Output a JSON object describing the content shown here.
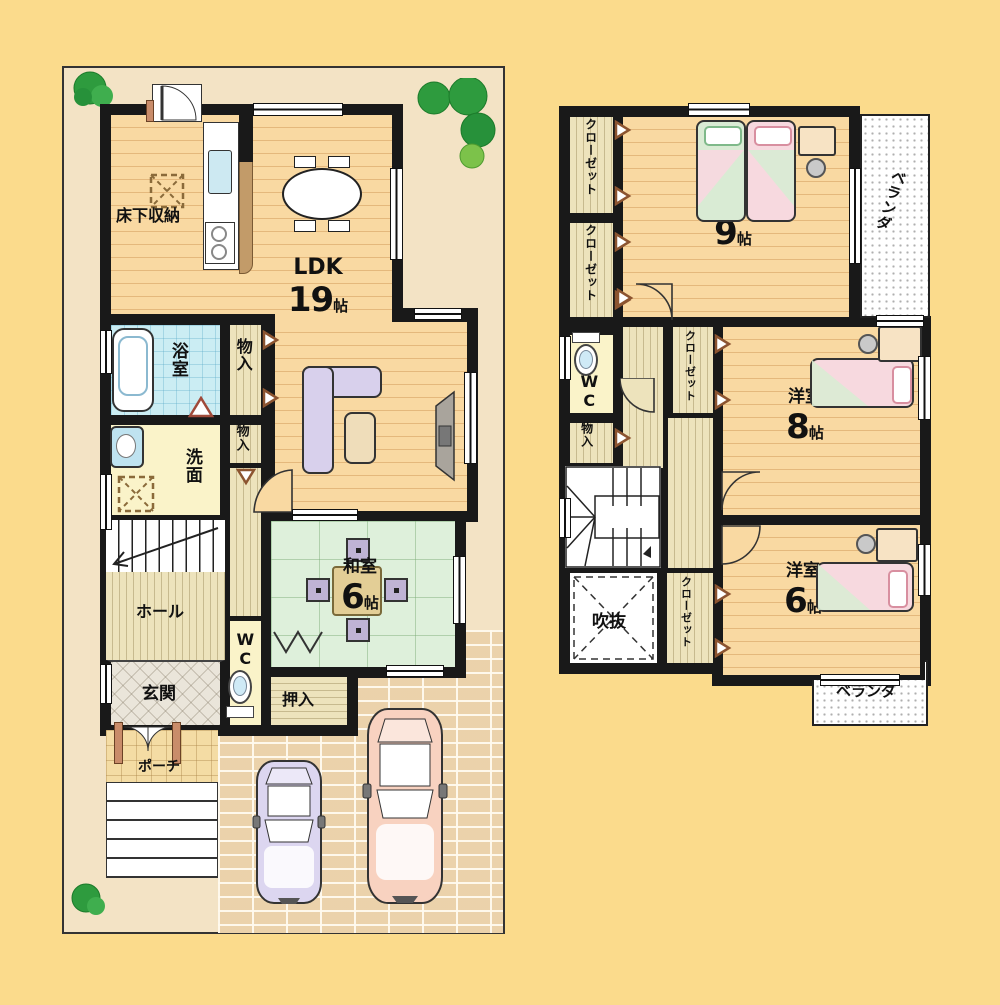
{
  "floor1": {
    "rooms": {
      "ldk": {
        "label": "LDK",
        "size": "19",
        "unit": "帖"
      },
      "floor_storage": {
        "label": "床下収納"
      },
      "bath": {
        "label": "浴室"
      },
      "storage_a": {
        "label": "物入"
      },
      "storage_b": {
        "label": "物入"
      },
      "washroom": {
        "label": "洗面"
      },
      "hall": {
        "label": "ホール"
      },
      "entrance": {
        "label": "玄関"
      },
      "wc": {
        "label": "WC"
      },
      "japanese_room": {
        "label": "和室",
        "size": "6",
        "unit": "帖"
      },
      "oshiire": {
        "label": "押入"
      },
      "porch": {
        "label": "ポーチ"
      }
    }
  },
  "floor2": {
    "rooms": {
      "closet_a": {
        "label": "クローゼット"
      },
      "closet_b": {
        "label": "クローゼット"
      },
      "bedroom9": {
        "label": "洋室",
        "size": "9",
        "unit": "帖"
      },
      "veranda_top": {
        "label": "ベランダ"
      },
      "wc": {
        "label": "WC"
      },
      "storage": {
        "label": "物入"
      },
      "closet_c": {
        "label": "クローゼット"
      },
      "bedroom8": {
        "label": "洋室",
        "size": "8",
        "unit": "帖"
      },
      "void": {
        "label": "吹抜"
      },
      "closet_d": {
        "label": "クローゼット"
      },
      "bedroom6": {
        "label": "洋室",
        "size": "6",
        "unit": "帖"
      },
      "veranda_bottom": {
        "label": "ベランダ"
      }
    }
  },
  "colors": {
    "background": "#FBDB8C",
    "wall": "#191919",
    "site": "#F3E3C5",
    "wood_floor": "#F9D9A2",
    "tatami": "#DEF0DB",
    "bath_tile": "#CBEDF3",
    "brick": "#F3E0BF",
    "veranda": "#FFFFFF",
    "sofa": "#D8D0EC",
    "bed_pink": "#F7D9DF",
    "bed_green": "#D9EBD4",
    "car_left": "#DCD6F0",
    "car_right": "#F8D2C0"
  }
}
